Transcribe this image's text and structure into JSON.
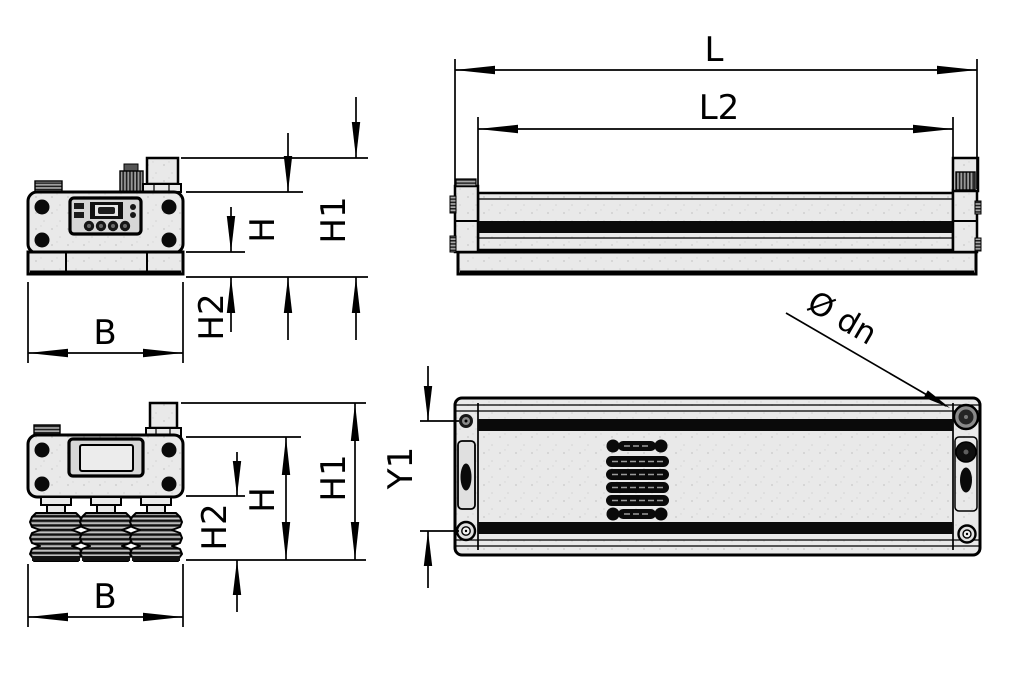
{
  "palette": {
    "background": "#ffffff",
    "ink": "#000000",
    "body_fill": "#e9e9e9",
    "detail_fill": "#0a0a0a"
  },
  "views": {
    "front": {
      "dims": {
        "B": "B",
        "H": "H",
        "H1": "H1",
        "H2": "H2"
      }
    },
    "side": {
      "dims": {
        "L": "L",
        "L2": "L2"
      }
    },
    "front_bellows": {
      "dims": {
        "B": "B",
        "H": "H",
        "H1": "H1",
        "H2": "H2"
      }
    },
    "top": {
      "dims": {
        "Y1": "Y1",
        "dn": "Ø dn"
      }
    }
  }
}
